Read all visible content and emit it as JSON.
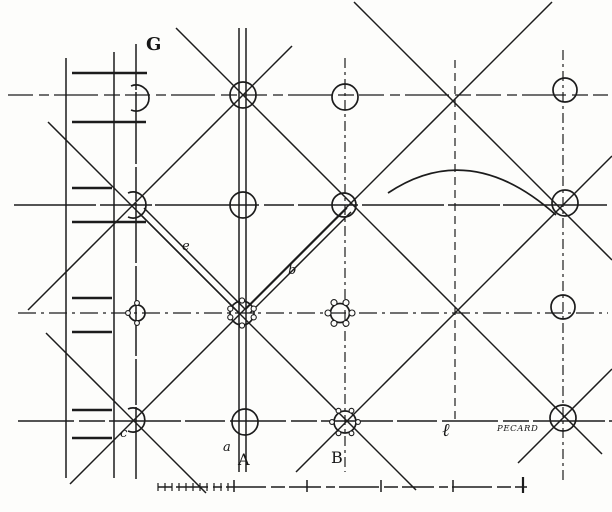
{
  "figure": {
    "kind": "antique engineering plan drawing (scaffolding / column grid with diagonal bracing)",
    "labels": {
      "g": "G",
      "e": "e",
      "b": "b",
      "c": "c",
      "a": "a",
      "A": "A",
      "B": "B",
      "l": "ℓ"
    },
    "signature": "PECARD",
    "colors": {
      "ink": "#1c1c1c",
      "paper": "#fdfdfb"
    }
  }
}
